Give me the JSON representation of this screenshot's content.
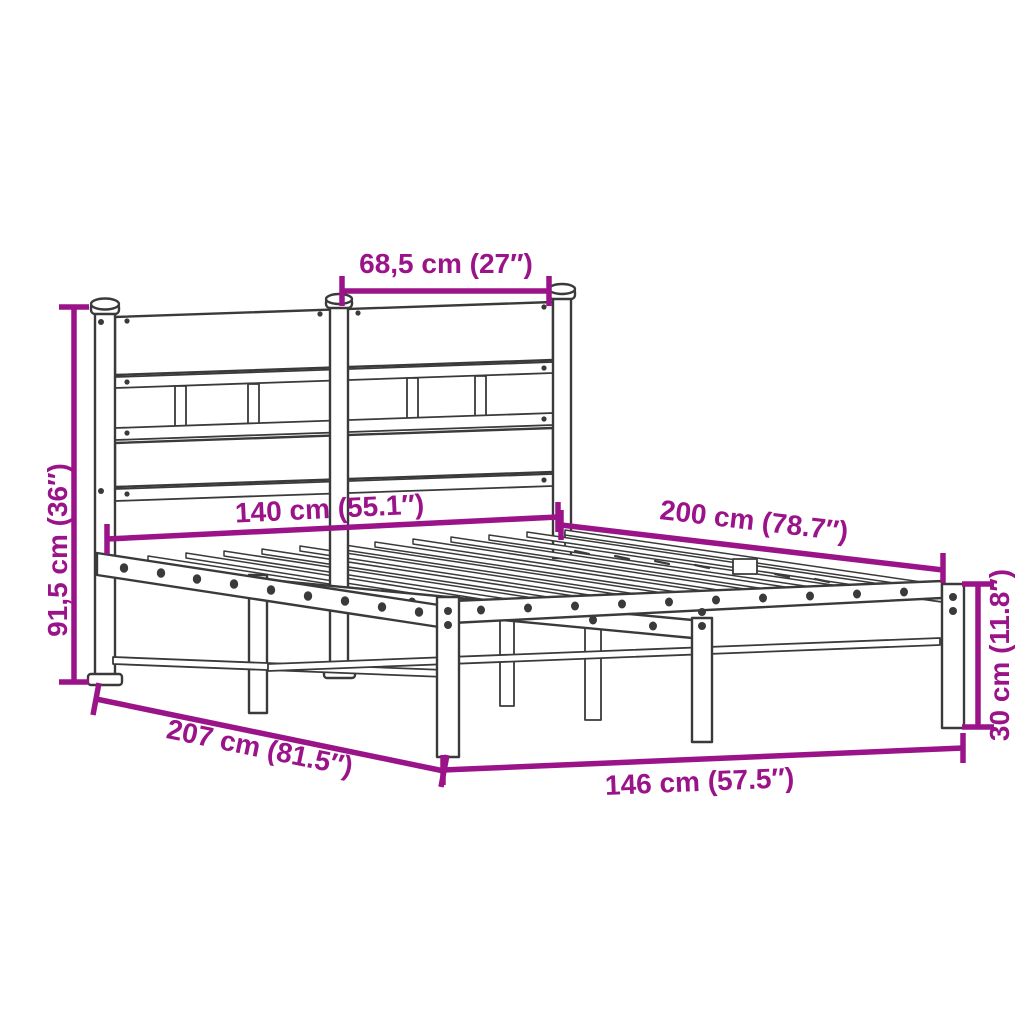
{
  "figure": {
    "kind": "product-dimension-diagram",
    "subject": "metal-bed-frame-with-headboard",
    "background_color": "#ffffff",
    "accent_color": "#9b1389",
    "line_color": "#3a3a3a"
  },
  "dimensions": [
    {
      "id": "headboard-section-width",
      "cm": "68,5",
      "inches": "27",
      "label": "68,5 cm (27″)"
    },
    {
      "id": "headboard-height",
      "cm": "91,5",
      "inches": "36",
      "label": "91,5 cm (36″)"
    },
    {
      "id": "bed-width",
      "cm": "140",
      "inches": "55.1",
      "label": "140 cm (55.1″)"
    },
    {
      "id": "bed-length",
      "cm": "200",
      "inches": "78.7",
      "label": "200 cm (78.7″)"
    },
    {
      "id": "frame-height",
      "cm": "30",
      "inches": "11.8",
      "label": "30 cm (11.8″)"
    },
    {
      "id": "total-length",
      "cm": "207",
      "inches": "81.5",
      "label": "207 cm (81.5″)"
    },
    {
      "id": "total-width",
      "cm": "146",
      "inches": "57.5",
      "label": "146 cm (57.5″)"
    }
  ]
}
